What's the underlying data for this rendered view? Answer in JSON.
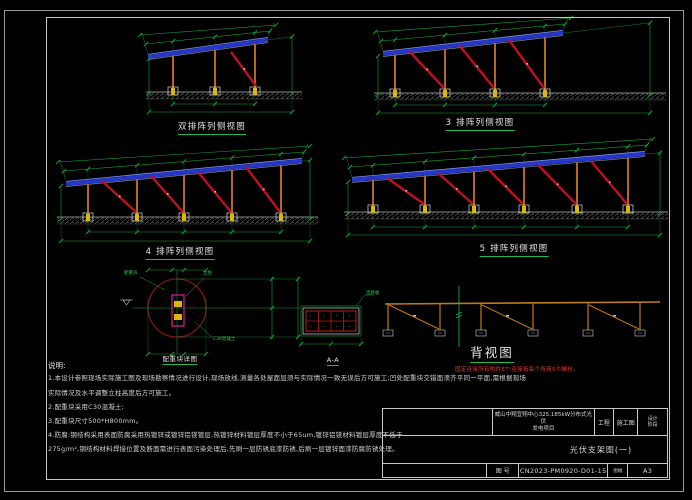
{
  "colors": {
    "dim": "#17a33c",
    "panel": "#2636c8",
    "panel_hi": "#8093ff",
    "post": "#b5681c",
    "brace": "#c01020",
    "footing": "#d9b70e",
    "ground": "#8a8a8a",
    "circle": "#7d1616",
    "pile": "#e01aa0",
    "grid_red": "#b02020",
    "beam": "#c07a18",
    "white_line": "#cfcfcf"
  },
  "views": [
    {
      "label": "双排阵列侧视图",
      "panel": [
        148,
        57,
        268,
        40
      ],
      "posts": [
        173,
        215,
        255
      ],
      "base_y": 88,
      "braces": [
        [
          231,
          52,
          256,
          86
        ]
      ],
      "ground": [
        146,
        302,
        92
      ],
      "ldx": 149,
      "rdx": 292,
      "dim1": 104,
      "dim2": 112,
      "label_x": 212,
      "label_y": 123
    },
    {
      "label": "3 排阵列侧视图",
      "panel": [
        383,
        54,
        563,
        33
      ],
      "posts": [
        395,
        445,
        495,
        545
      ],
      "base_y": 90,
      "braces": [
        [
          409,
          51,
          444,
          88
        ],
        [
          459,
          45,
          494,
          88
        ],
        [
          509,
          40,
          544,
          88
        ]
      ],
      "ground": [
        374,
        666,
        93
      ],
      "ldx": 378,
      "rdx": 650,
      "dim1": 105,
      "dim2": 113,
      "label_x": 480,
      "label_y": 119
    },
    {
      "label": "4 排阵列侧视图",
      "panel": [
        66,
        184,
        302,
        161
      ],
      "posts": [
        88,
        137,
        184,
        232,
        281
      ],
      "base_y": 214,
      "braces": [
        [
          102,
          181,
          136,
          212
        ],
        [
          151,
          176,
          183,
          212
        ],
        [
          198,
          172,
          231,
          212
        ],
        [
          246,
          167,
          280,
          212
        ]
      ],
      "ground": [
        57,
        318,
        217
      ],
      "ldx": 61,
      "rdx": 310,
      "dim1": 232,
      "dim2": 241,
      "label_x": 180,
      "label_y": 248
    },
    {
      "label": "5 排阵列侧视图",
      "panel": [
        352,
        180,
        645,
        154
      ],
      "posts": [
        373,
        425,
        474,
        524,
        577,
        628
      ],
      "base_y": 206,
      "braces": [
        [
          387,
          178,
          424,
          204
        ],
        [
          439,
          174,
          473,
          204
        ],
        [
          488,
          169,
          523,
          204
        ],
        [
          538,
          165,
          576,
          204
        ],
        [
          591,
          161,
          627,
          204
        ]
      ],
      "ground": [
        344,
        668,
        212
      ],
      "ldx": 348,
      "rdx": 660,
      "dim1": 227,
      "dim2": 235,
      "label_x": 514,
      "label_y": 245
    }
  ],
  "detail": {
    "label": "配重块详图",
    "cx": 177,
    "cy": 308,
    "r": 29,
    "pile": [
      172,
      295,
      12,
      31
    ],
    "annotations": [
      {
        "text": "配重块",
        "x": 124,
        "y": 272
      },
      {
        "text": "立柱",
        "x": 203,
        "y": 272
      },
      {
        "text": "C30混凝土",
        "x": 213,
        "y": 338
      }
    ],
    "label_x": 180,
    "label_y": 356
  },
  "section_aa": {
    "label": "A-A",
    "rect": [
      301,
      306,
      60,
      30
    ],
    "callout": {
      "text": "连接板",
      "x": 366,
      "y": 292
    },
    "label_x": 333,
    "label_y": 357
  },
  "back_view": {
    "label": "背视图",
    "warning": "固定连接所有构件5T!连接板每个所用5个螺栓。",
    "beam": [
      385,
      304,
      660,
      302
    ],
    "posts": [
      388,
      440,
      481,
      533,
      588,
      640
    ],
    "post_bottom": 330,
    "pairs": [
      [
        0,
        1
      ],
      [
        2,
        3
      ],
      [
        4,
        5
      ]
    ],
    "centerline_x": 459,
    "label_x": 492,
    "label_y": 347,
    "warn_x": 455,
    "warn_y": 368
  },
  "notes": {
    "heading": "说明:",
    "lines": [
      "1.本设计参照现场实际施工图及现场勘察情况进行设计,现场放线,测量各处屋面层须与实际情况一致无误后方可施工;凹处配重块交错面须齐平同一平面,需根据现场",
      "实际情况及水平调整立柱高度后方可施工。",
      "2.配重块采用C30混凝土;",
      "3.配重块尺寸500*H800mm。",
      "4.防腐:钢结构采用表面防腐采用热镀锌或镀锌铝镁镀层,热镀锌材料镀层厚度不小于65um,镀锌铝镁材料镀层厚度不低于",
      "275g/m²,钢结构材料焊接位置及断面需进行表面污染处理后,先刷一层防锈底漆防锈,后刷一层镀锌面漆防腐防锈处理。"
    ]
  },
  "title_block": {
    "project_line1": "威山中翔宜翔中心325.185kW分布式光伏",
    "project_line2": "发电项目",
    "project_suffix": "工程",
    "stage": "施工图",
    "phase_top": "设计",
    "phase_bottom": "阶段",
    "drawing_title": "光伏支架图(一)",
    "drawing_no_label": "图 号",
    "drawing_no": "CN2023-PM0920-D01-15",
    "sheet_label": "图幅",
    "sheet": "A3"
  }
}
